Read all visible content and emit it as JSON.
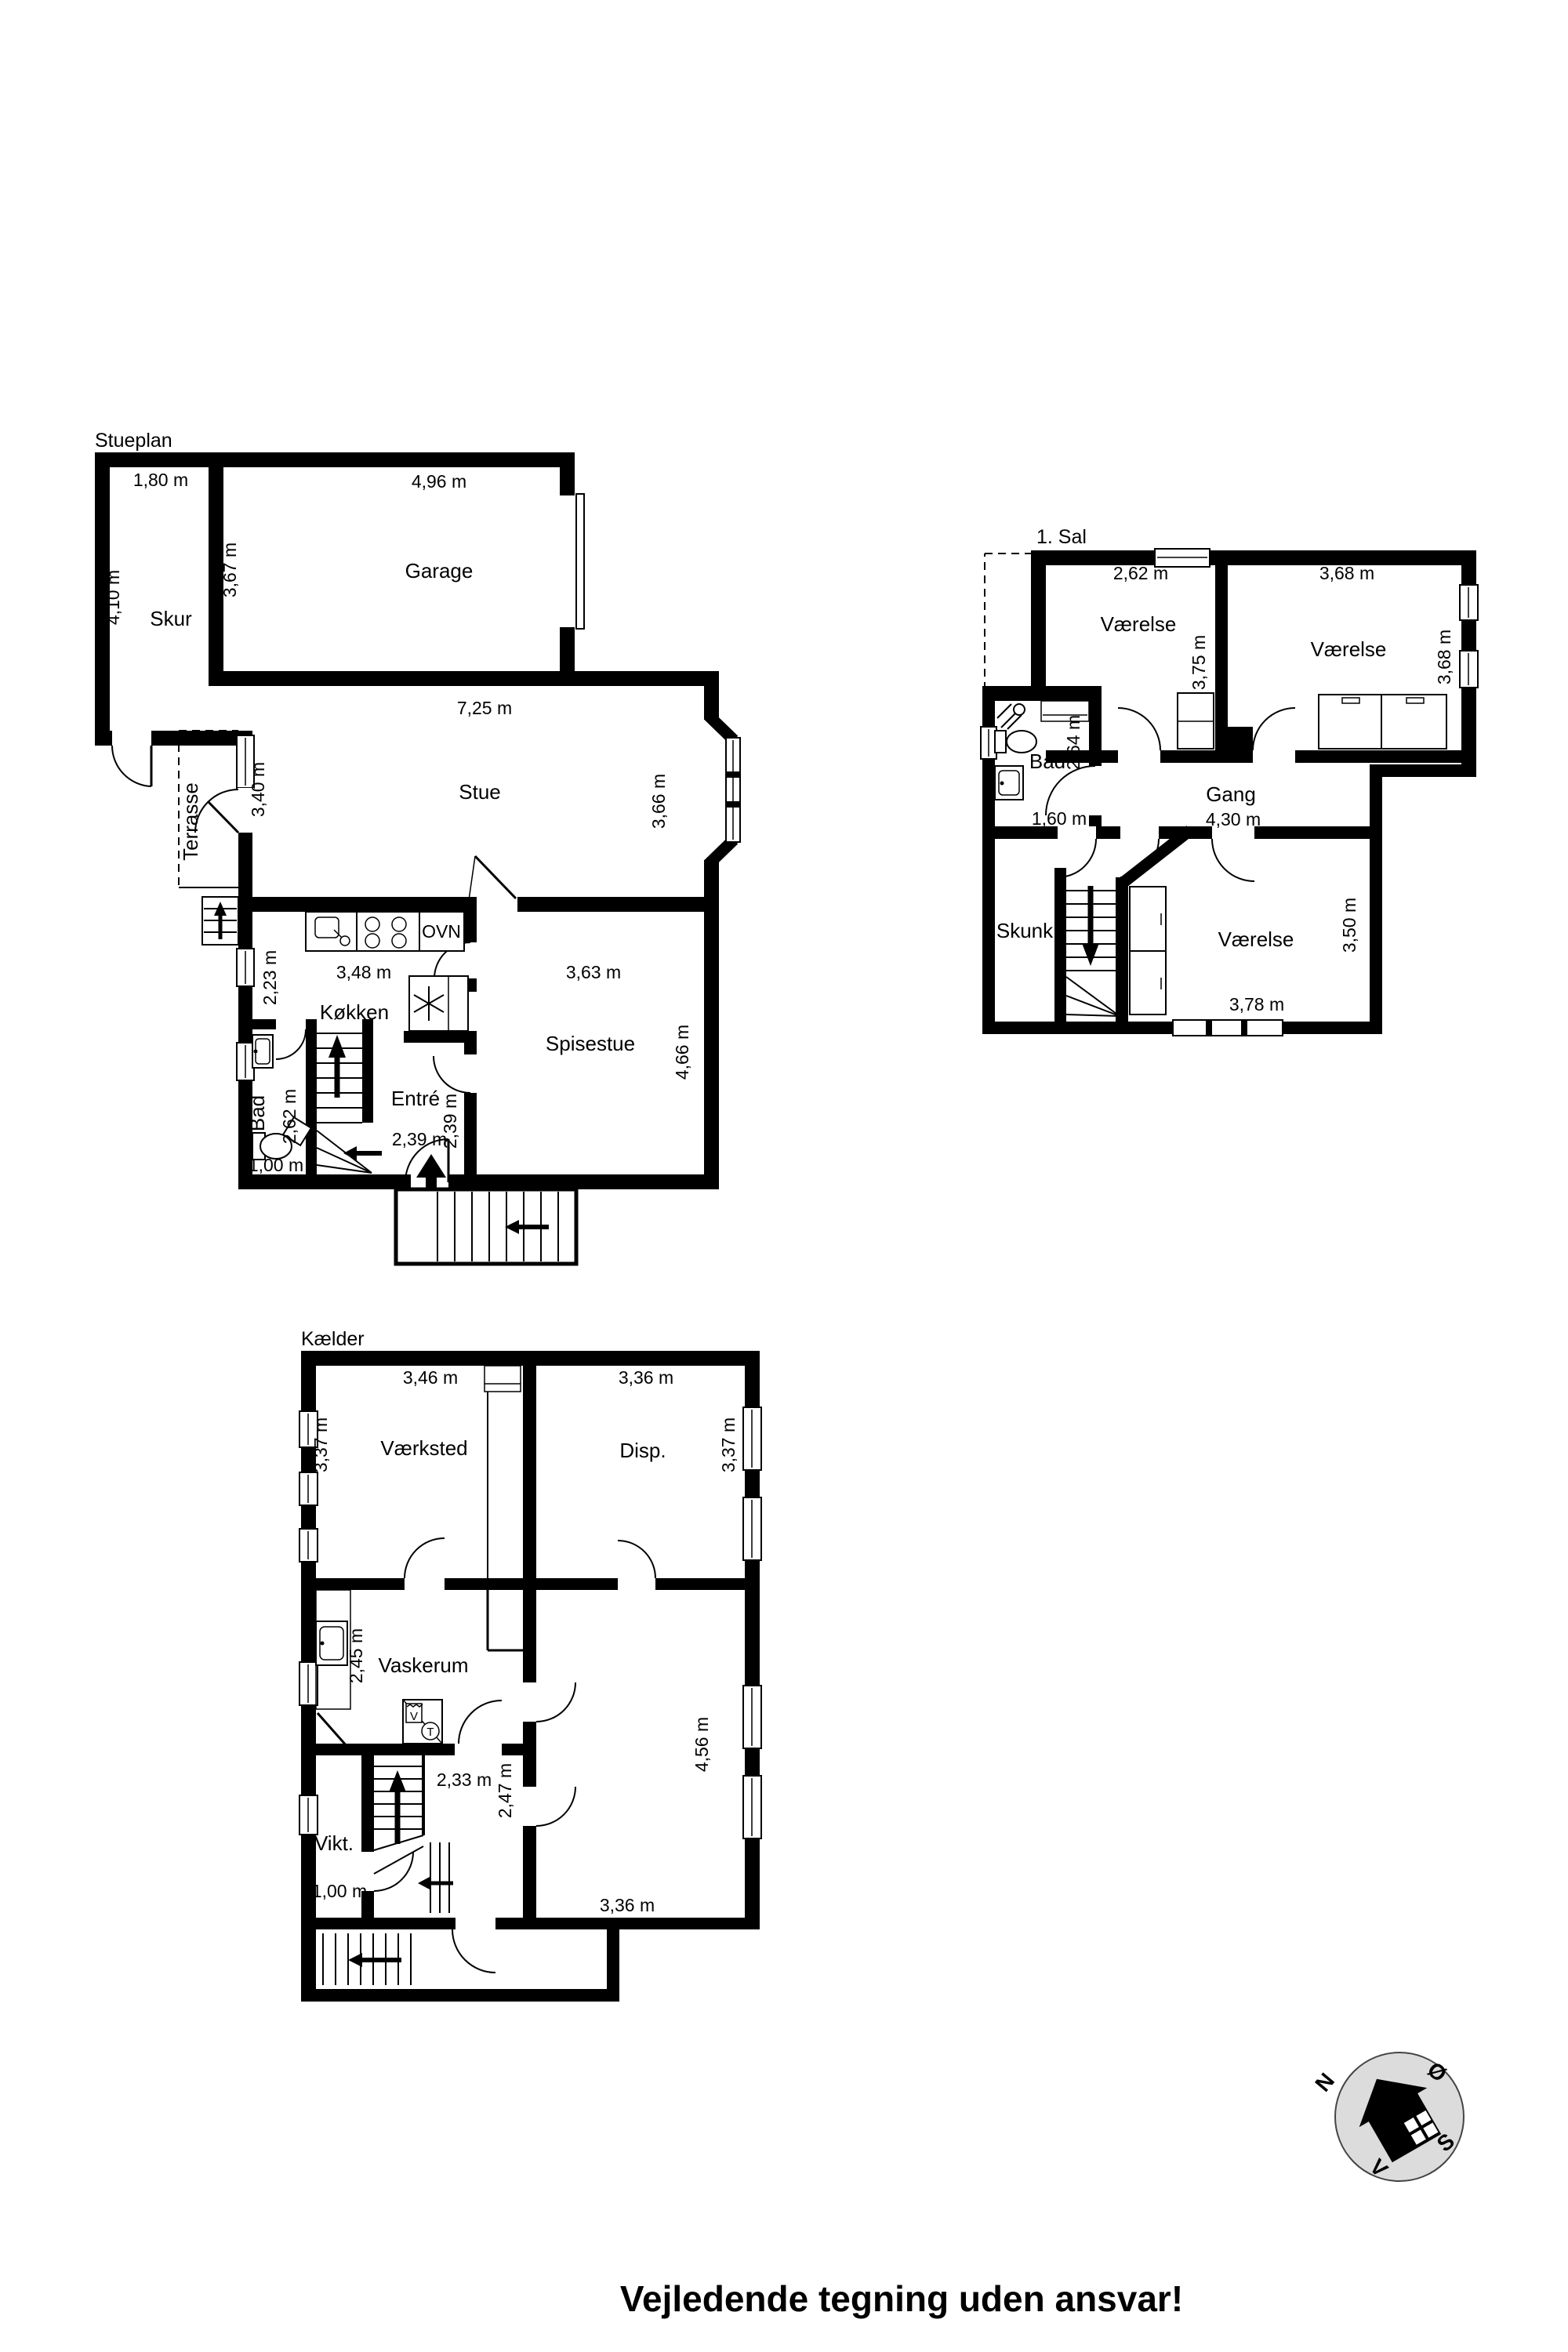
{
  "footer": "Vejledende tegning uden ansvar!",
  "colors": {
    "wall": "#000000",
    "background": "#ffffff",
    "compass_fill": "#dcdcdc"
  },
  "compass": {
    "north": "N",
    "east": "Ø",
    "south": "S",
    "west": "V"
  },
  "stueplan": {
    "label": "Stueplan",
    "rooms": {
      "skur": "Skur",
      "garage": "Garage",
      "stue": "Stue",
      "terrasse": "Terrasse",
      "kokken": "Køkken",
      "spisestue": "Spisestue",
      "bad": "Bad",
      "entre": "Entré"
    },
    "appliances": {
      "oven": "OVN"
    },
    "dims": {
      "skur_w": "1,80 m",
      "skur_h": "4,10 m",
      "garage_w": "4,96 m",
      "garage_h": "3,67 m",
      "stue_w": "7,25 m",
      "stue_h": "3,66 m",
      "terrasse_h": "3,40 m",
      "kokken_w": "3,48 m",
      "kokken_h": "2,23 m",
      "spisestue_w": "3,63 m",
      "spisestue_h": "4,66 m",
      "bad_h": "2,62 m",
      "bad_w": "1,00 m",
      "entre_w": "2,39 m",
      "entre_h": "2,39 m"
    }
  },
  "sal1": {
    "label": "1. Sal",
    "rooms": {
      "vaerelse1": "Værelse",
      "vaerelse2": "Værelse",
      "vaerelse3": "Værelse",
      "bad": "Bad",
      "gang": "Gang",
      "skunk": "Skunk"
    },
    "dims": {
      "v1_w": "2,62 m",
      "v1_h": "3,75 m",
      "v2_w": "3,68 m",
      "v2_h": "3,68 m",
      "bad_h": "2,64 m",
      "bad_w": "1,60 m",
      "gang_w": "4,30 m",
      "v3_w": "3,78 m",
      "v3_h": "3,50 m"
    }
  },
  "kaelder": {
    "label": "Kælder",
    "rooms": {
      "vaerksted": "Værksted",
      "disp": "Disp.",
      "vaskerum": "Vaskerum",
      "vikt": "Vikt."
    },
    "appliances": {
      "washer": "V",
      "dryer": "T"
    },
    "dims": {
      "vaerksted_w": "3,46 m",
      "vaerksted_h": "3,37 m",
      "disp_w": "3,36 m",
      "disp_h": "3,37 m",
      "vaskerum_h": "2,45 m",
      "hall_w": "2,33 m",
      "hall_h": "2,47 m",
      "vikt_w": "1,00 m",
      "room_w": "3,36 m",
      "room_h": "4,56 m"
    }
  }
}
